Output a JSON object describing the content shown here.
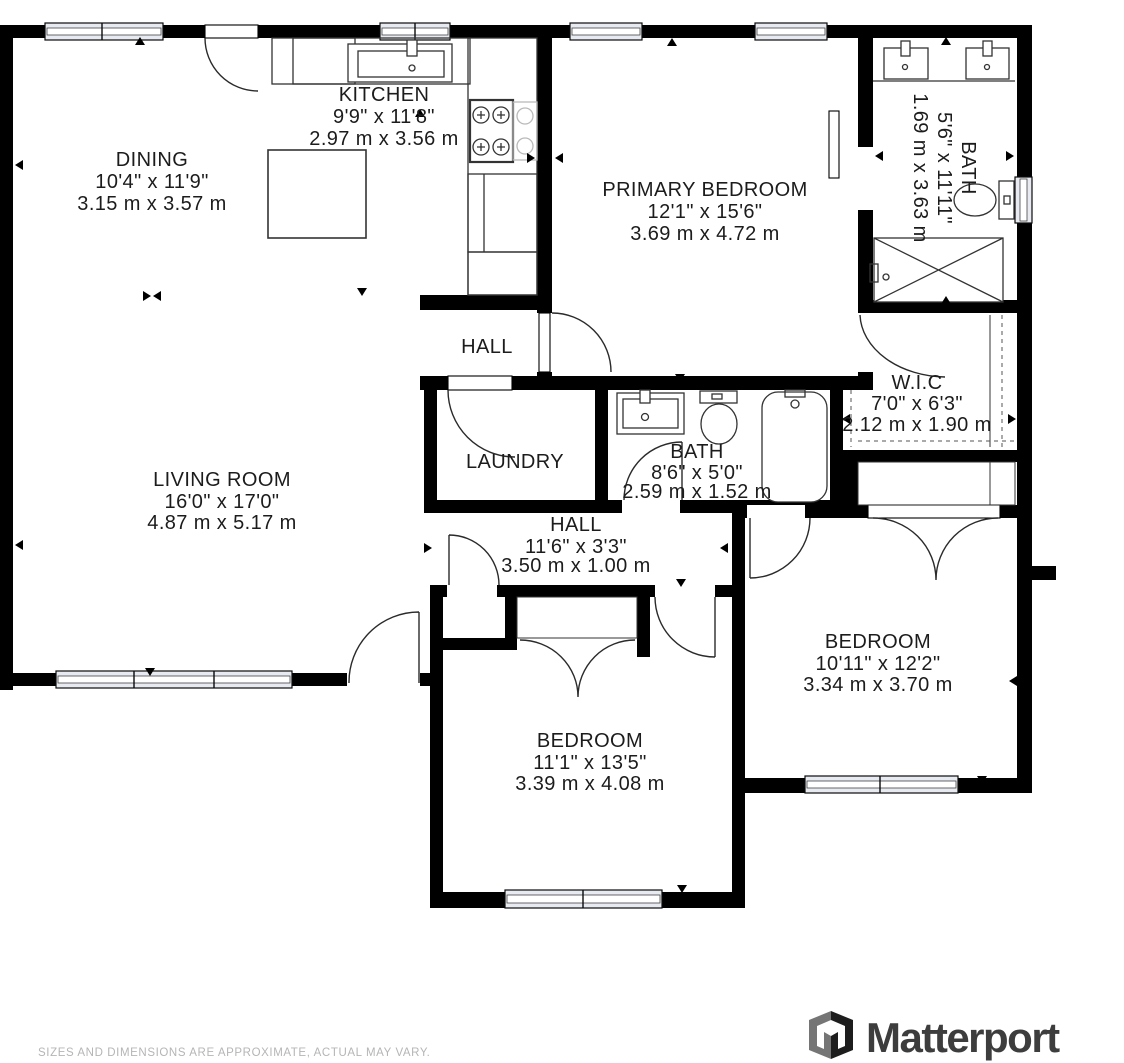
{
  "rooms": [
    {
      "id": "dining",
      "name": "DINING",
      "imperial": "10'4\" x 11'9\"",
      "metric": "3.15 m x 3.57 m"
    },
    {
      "id": "kitchen",
      "name": "KITCHEN",
      "imperial": "9'9\" x 11'8\"",
      "metric": "2.97 m x 3.56 m"
    },
    {
      "id": "primary-bedroom",
      "name": "PRIMARY BEDROOM",
      "imperial": "12'1\" x 15'6\"",
      "metric": "3.69 m x 4.72 m"
    },
    {
      "id": "primary-bath",
      "name": "BATH",
      "imperial": "5'6\" x 11'11\"",
      "metric": "1.69 m x 3.63 m"
    },
    {
      "id": "hall-upper",
      "name": "HALL",
      "imperial": "",
      "metric": ""
    },
    {
      "id": "laundry",
      "name": "LAUNDRY",
      "imperial": "",
      "metric": ""
    },
    {
      "id": "bath",
      "name": "BATH",
      "imperial": "8'6\" x 5'0\"",
      "metric": "2.59 m x 1.52 m"
    },
    {
      "id": "wic",
      "name": "W.I.C",
      "imperial": "7'0\" x 6'3\"",
      "metric": "2.12 m x 1.90 m"
    },
    {
      "id": "living-room",
      "name": "LIVING ROOM",
      "imperial": "16'0\" x 17'0\"",
      "metric": "4.87 m x 5.17 m"
    },
    {
      "id": "hall-lower",
      "name": "HALL",
      "imperial": "11'6\" x 3'3\"",
      "metric": "3.50 m x 1.00 m"
    },
    {
      "id": "bedroom-right",
      "name": "BEDROOM",
      "imperial": "10'11\" x 12'2\"",
      "metric": "3.34 m x 3.70 m"
    },
    {
      "id": "bedroom-middle",
      "name": "BEDROOM",
      "imperial": "11'1\" x 13'5\"",
      "metric": "3.39 m x 4.08 m"
    }
  ],
  "footer": {
    "disclaimer": "SIZES AND DIMENSIONS ARE APPROXIMATE, ACTUAL MAY VARY."
  },
  "branding": {
    "logo_text": "Matterport"
  },
  "colors": {
    "wall": "#000000",
    "label": "#1c1c1c",
    "window_fill": "#e7eaf1",
    "muted_text": "#b5b5b5",
    "logo": "#3d3d3d"
  }
}
